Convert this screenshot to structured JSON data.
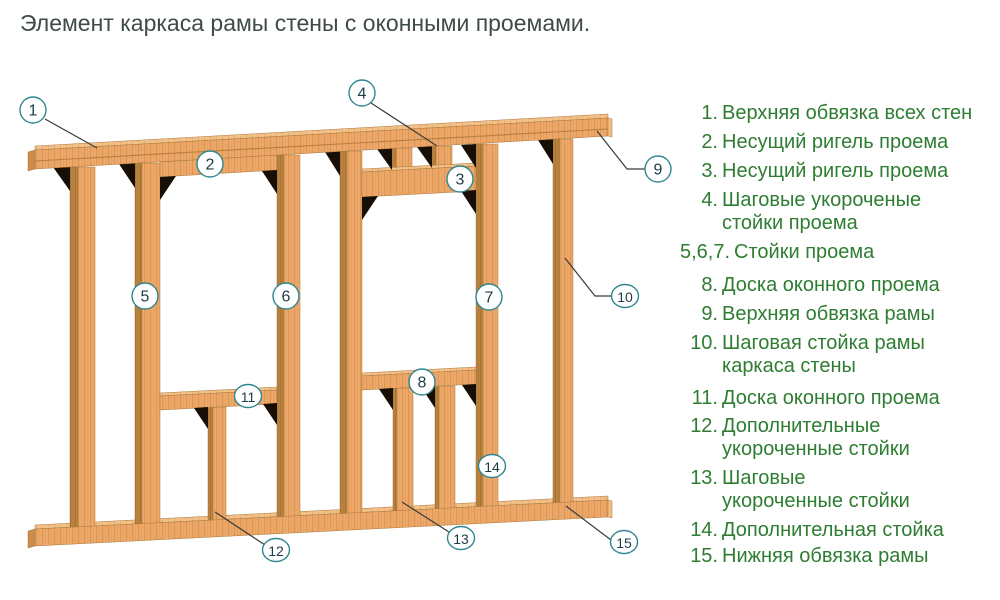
{
  "title": "Элемент каркаса рамы стены с оконными проемами.",
  "colors": {
    "legend_green": "#2e7d32",
    "title_color": "#3e4c44",
    "wood_front": "#eda96c",
    "wood_side": "#b9823f",
    "wood_top": "#f4c08a",
    "wood_end": "#c98c4c",
    "shadow_wedge": "#170e05",
    "callout_stroke": "#2f8691",
    "callout_text": "#1d3b46",
    "leader_line": "#3b3b3b"
  },
  "legend": {
    "items": [
      {
        "num": "1.",
        "lines": [
          "Верхняя обвязка всех стен"
        ],
        "top": 102
      },
      {
        "num": "2.",
        "lines": [
          "Несущий ригель проема"
        ],
        "top": 131
      },
      {
        "num": "3.",
        "lines": [
          "Несущий ригель проема"
        ],
        "top": 160
      },
      {
        "num": "4.",
        "lines": [
          "Шаговые укороченые",
          "стойки проема"
        ],
        "top": 189
      },
      {
        "num": "5,6,7.",
        "lines": [
          "Стойки проема"
        ],
        "top": 241
      },
      {
        "num": "8.",
        "lines": [
          "Доска оконного проема"
        ],
        "top": 274
      },
      {
        "num": "9.",
        "lines": [
          "Верхняя обвязка рамы"
        ],
        "top": 303
      },
      {
        "num": "10.",
        "lines": [
          "Шаговая стойка рамы",
          "каркаса стены"
        ],
        "top": 332
      },
      {
        "num": "11.",
        "lines": [
          "Доска оконного проема"
        ],
        "top": 387
      },
      {
        "num": "12.",
        "lines": [
          "Дополнительные",
          "укороченные стойки"
        ],
        "top": 415
      },
      {
        "num": "13.",
        "lines": [
          "Шаговые",
          "укороченные стойки"
        ],
        "top": 467
      },
      {
        "num": "14.",
        "lines": [
          "Дополнительная стойка"
        ],
        "top": 519
      },
      {
        "num": "15.",
        "lines": [
          "Нижняя обвязка рамы"
        ],
        "top": 545
      }
    ]
  },
  "callouts": [
    {
      "n": "1",
      "x": 33,
      "y": 110,
      "wide": false
    },
    {
      "n": "2",
      "x": 210,
      "y": 164,
      "wide": false
    },
    {
      "n": "3",
      "x": 460,
      "y": 179,
      "wide": false
    },
    {
      "n": "4",
      "x": 362,
      "y": 93,
      "wide": false
    },
    {
      "n": "5",
      "x": 145,
      "y": 296,
      "wide": false
    },
    {
      "n": "6",
      "x": 286,
      "y": 296,
      "wide": false
    },
    {
      "n": "7",
      "x": 489,
      "y": 297,
      "wide": false
    },
    {
      "n": "8",
      "x": 422,
      "y": 382,
      "wide": false
    },
    {
      "n": "9",
      "x": 658,
      "y": 169,
      "wide": false
    },
    {
      "n": "10",
      "x": 625,
      "y": 296,
      "wide": true
    },
    {
      "n": "11",
      "x": 248,
      "y": 396,
      "wide": true
    },
    {
      "n": "12",
      "x": 276,
      "y": 550,
      "wide": true
    },
    {
      "n": "13",
      "x": 461,
      "y": 538,
      "wide": true
    },
    {
      "n": "14",
      "x": 492,
      "y": 466,
      "wide": true
    },
    {
      "n": "15",
      "x": 624,
      "y": 542,
      "wide": true
    }
  ]
}
